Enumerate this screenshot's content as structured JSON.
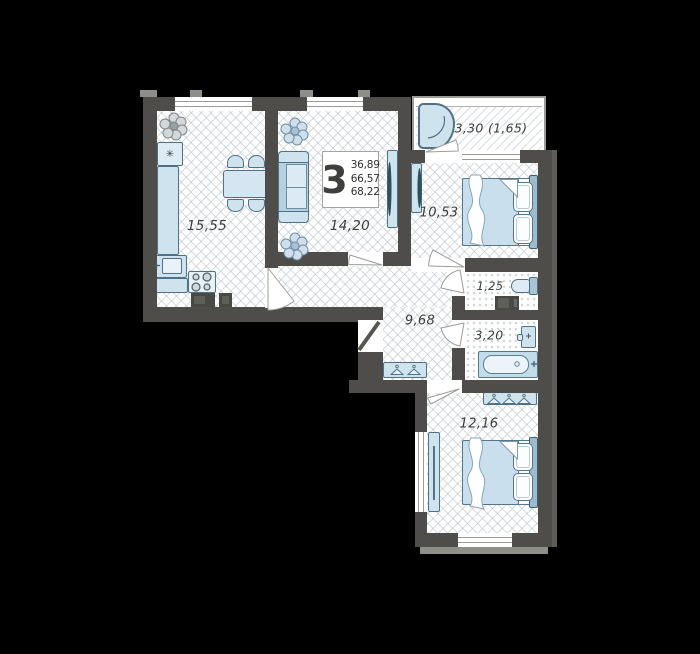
{
  "unit": {
    "rooms_count": "3",
    "area_lines": [
      "36,89",
      "66,57",
      "68,22"
    ]
  },
  "rooms": {
    "kitchen": {
      "label": "15,55"
    },
    "living": {
      "label": "14,20"
    },
    "bedroom_top": {
      "label": "10,53"
    },
    "balcony": {
      "label": "3,30 (1,65)"
    },
    "wc": {
      "label": "1,25"
    },
    "bathroom": {
      "label": "3,20"
    },
    "hallway": {
      "label": "9,68"
    },
    "bedroom_bottom": {
      "label": "12,16"
    }
  },
  "icons": {
    "fridge_snowflake": "✳"
  },
  "colors": {
    "background": "#000000",
    "wall": "#4e4d49",
    "floor": "#ffffff",
    "furniture_fill": "#d5e6f2",
    "furniture_outline": "#4f7187",
    "label_text": "#3c3c3a"
  }
}
